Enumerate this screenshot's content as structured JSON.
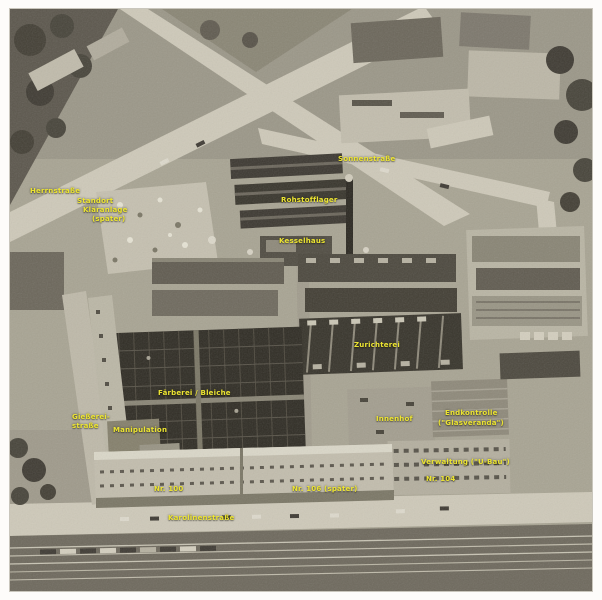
{
  "image": {
    "kind": "aerial-photograph",
    "tone": "black-and-white"
  },
  "colors": {
    "label": "#ece432",
    "frame": "#fdfcfa"
  },
  "labels": [
    {
      "text": "Herrnstraße",
      "x": 30,
      "y": 188
    },
    {
      "text": "Standort",
      "x": 77,
      "y": 198
    },
    {
      "text": "Kläranlage",
      "x": 83,
      "y": 207
    },
    {
      "text": "(später)",
      "x": 92,
      "y": 216
    },
    {
      "text": "Sonnenstraße",
      "x": 338,
      "y": 156
    },
    {
      "text": "Rohstofflager",
      "x": 281,
      "y": 197
    },
    {
      "text": "Kesselhaus",
      "x": 279,
      "y": 238
    },
    {
      "text": "Zurichterei",
      "x": 354,
      "y": 342
    },
    {
      "text": "Färberei / Bleiche",
      "x": 158,
      "y": 390
    },
    {
      "text": "Gießerei-",
      "x": 72,
      "y": 414
    },
    {
      "text": "straße",
      "x": 72,
      "y": 423
    },
    {
      "text": "Manipulation",
      "x": 113,
      "y": 427
    },
    {
      "text": "Innenhof",
      "x": 376,
      "y": 416
    },
    {
      "text": "Endkontrolle",
      "x": 445,
      "y": 410
    },
    {
      "text": "(\"Glasveranda\")",
      "x": 438,
      "y": 420
    },
    {
      "text": "Verwaltung (\"U-Bau\")",
      "x": 421,
      "y": 459
    },
    {
      "text": "Nr. 104",
      "x": 426,
      "y": 476
    },
    {
      "text": "Nr. 100",
      "x": 154,
      "y": 486
    },
    {
      "text": "Nr. 106 (später)",
      "x": 292,
      "y": 486
    },
    {
      "text": "Karolinenstraße",
      "x": 168,
      "y": 515
    }
  ]
}
